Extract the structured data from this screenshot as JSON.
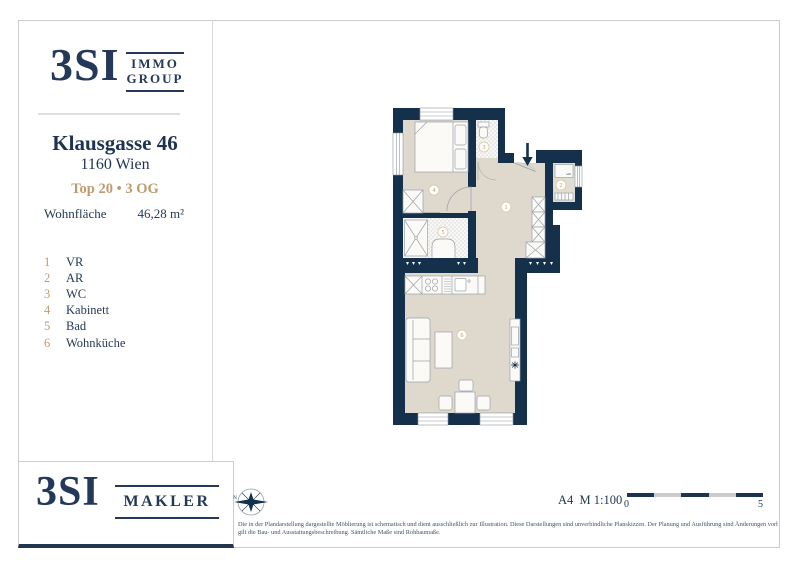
{
  "header": {
    "brand": {
      "big": "3SI",
      "top": "IMMO",
      "bottom": "GROUP"
    },
    "address_line1": "Klausgasse 46",
    "address_line2": "1160 Wien",
    "unit_line": "Top 20 • 3 OG",
    "area_label": "Wohnfläche",
    "area_value": "46,28 m²"
  },
  "legend": {
    "items": [
      {
        "num": "1",
        "label": "VR"
      },
      {
        "num": "2",
        "label": "AR"
      },
      {
        "num": "3",
        "label": "WC"
      },
      {
        "num": "4",
        "label": "Kabinett"
      },
      {
        "num": "5",
        "label": "Bad"
      },
      {
        "num": "6",
        "label": "Wohnküche"
      }
    ]
  },
  "plan": {
    "washer_label": "wm"
  },
  "footer": {
    "brand_big": "3SI",
    "brand_word": "MAKLER",
    "compass_n": "N",
    "format_scale": "A4  M 1:100",
    "scale_start": "0",
    "scale_end": "5",
    "disclaimer_line1": "Die in der Plandarstellung dargestellte Möblierung ist schematisch und dient ausschließlich zur Illustration. Diese Darstellungen sind unverbindliche Planskizzen. Der Planung und Ausführung sind Änderungen vorbehalten. Es",
    "disclaimer_line2": "gilt die Bau- und Ausstattungsbeschreibung. Sämtliche Maße sind Rohbaumaße."
  },
  "colors": {
    "navy": "#14304a",
    "gold": "#bf9a6e",
    "floor": "#ded8cd"
  }
}
